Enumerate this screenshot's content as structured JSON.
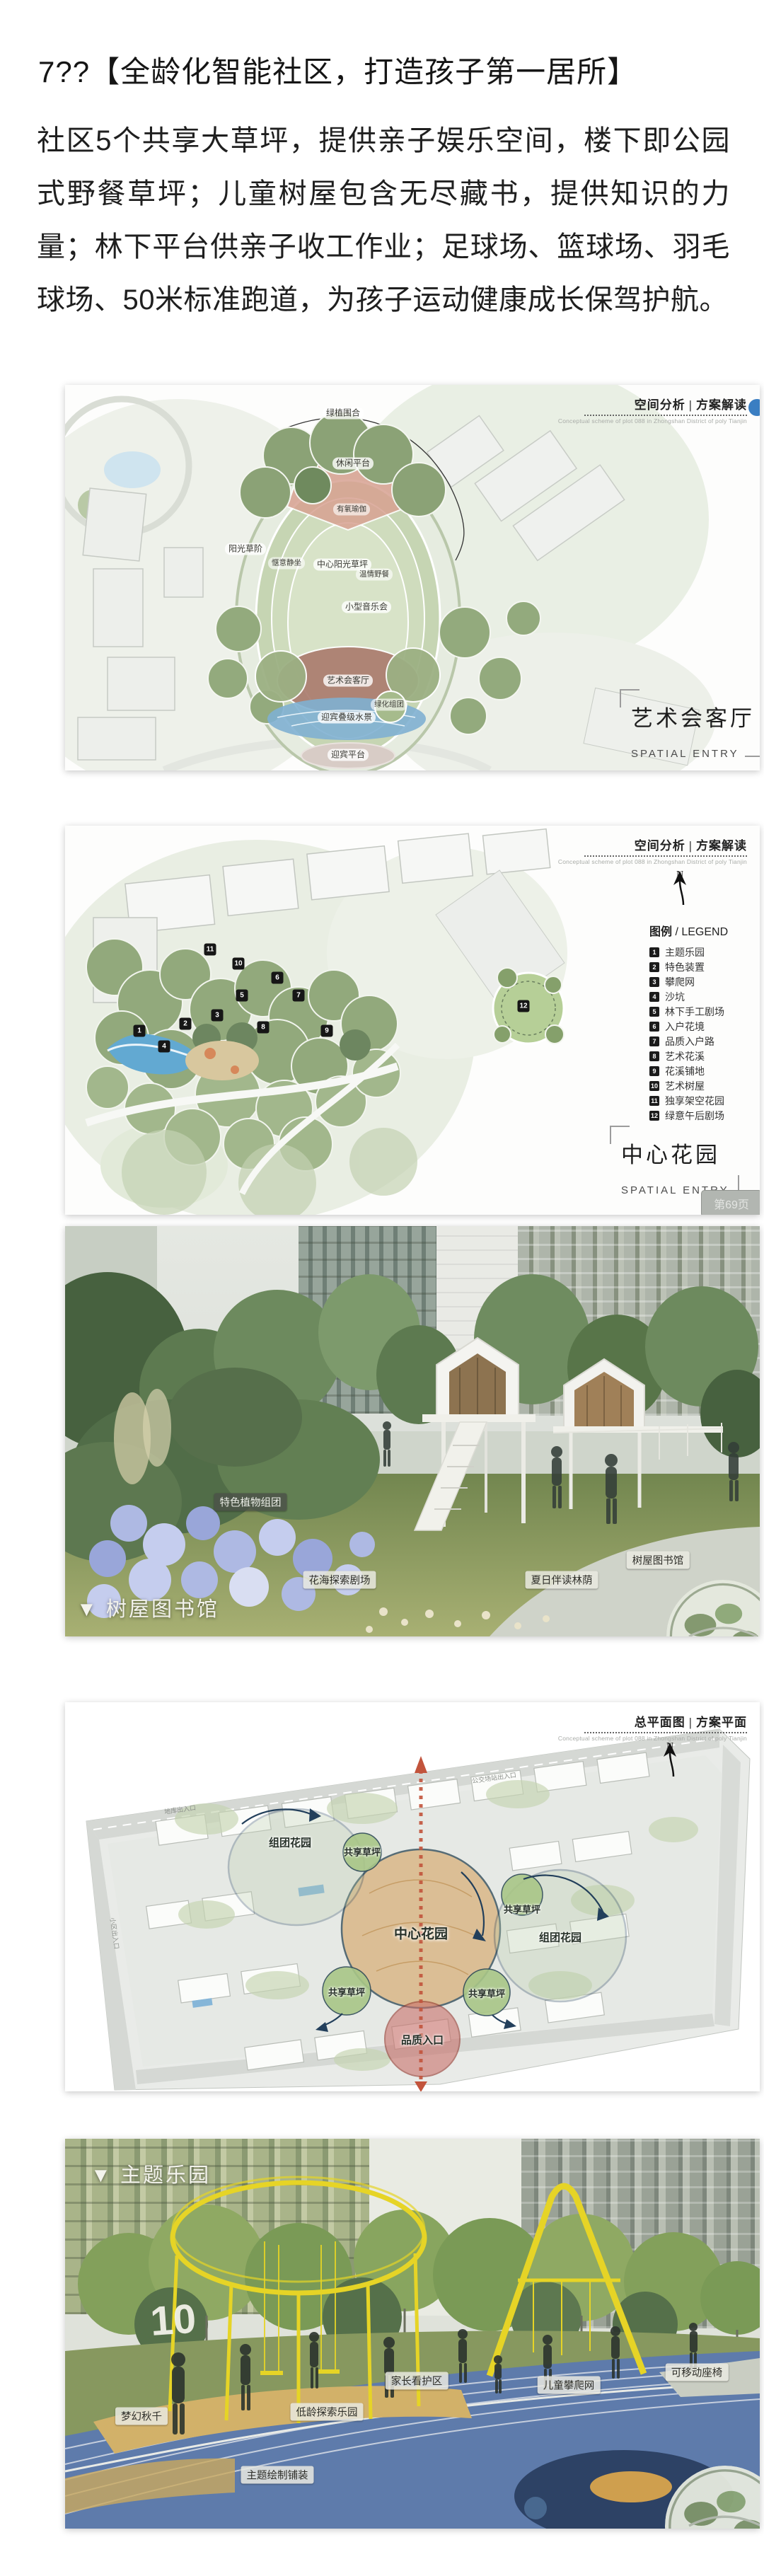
{
  "page": {
    "title": "7??【全龄化智能社区，打造孩子第一居所】",
    "paragraph": "社区5个共享大草坪，提供亲子娱乐空间，楼下即公园式野餐草坪；儿童树屋包含无尽藏书，提供知识的力量；林下平台供亲子收工作业；足球场、篮球场、羽毛球场、50米标准跑道，为孩子运动健康成长保驾护航。"
  },
  "slide_header": {
    "cn_analysis": "空间分析 | 方案解读",
    "cn_masterplan": "总平面图 | 方案平面",
    "en": "Conceptual scheme of plot 088 in Zhongshan District of poly Tianjin"
  },
  "figure1": {
    "labels": {
      "enclosure": "绿植围合",
      "leisure": "休闲平台",
      "yoga": "有氧瑜伽",
      "lawn_steps": "阳光草阶",
      "sitting": "惬意静坐",
      "central_lawn": "中心阳光草坪",
      "picnic": "温情野餐",
      "concert": "小型音乐会",
      "art_hall": "艺术会客厅",
      "green_cluster": "绿化组团",
      "water": "迎宾叠级水景",
      "platform": "迎宾平台"
    },
    "side_title": "艺术会客厅",
    "side_subtitle": "SPATIAL ENTRY"
  },
  "figure2": {
    "north": "N",
    "legend_title_cn": "图例",
    "legend_title_en": " / LEGEND",
    "legend": [
      {
        "num": "1",
        "label": "主题乐园"
      },
      {
        "num": "2",
        "label": "特色装置"
      },
      {
        "num": "3",
        "label": "攀爬网"
      },
      {
        "num": "4",
        "label": "沙坑"
      },
      {
        "num": "5",
        "label": "林下手工剧场"
      },
      {
        "num": "6",
        "label": "入户花境"
      },
      {
        "num": "7",
        "label": "品质入户路"
      },
      {
        "num": "8",
        "label": "艺术花溪"
      },
      {
        "num": "9",
        "label": "花溪铺地"
      },
      {
        "num": "10",
        "label": "艺术树屋"
      },
      {
        "num": "11",
        "label": "独享架空花园"
      },
      {
        "num": "12",
        "label": "绿意午后剧场"
      }
    ],
    "side_title": "中心花园",
    "side_subtitle": "SPATIAL ENTRY",
    "page_badge": "第69页"
  },
  "figure3": {
    "tags": {
      "plants": "特色植物组团",
      "flower": "花海探索剧场",
      "reading": "夏日伴读林荫",
      "treehouse": "树屋图书馆"
    },
    "caption": "▼ 树屋图书馆"
  },
  "figure4": {
    "north": "N",
    "labels": {
      "center": "中心花园",
      "cluster": "组团花园",
      "lawn": "共享草坪",
      "entry": "品质入口"
    },
    "road_labels": {
      "left": "小区出入口",
      "top": "公交场站出入口",
      "garage": "地库出入口"
    }
  },
  "figure5": {
    "caption": "▼ 主题乐园",
    "sculpture": "10",
    "tags": {
      "swing": "梦幻秋千",
      "toddler": "低龄探索乐园",
      "guardian": "家长看护区",
      "climb": "儿童攀爬网",
      "seat": "可移动座椅",
      "paving": "主题绘制铺装"
    }
  },
  "colors": {
    "accent_blue": "#3a7ec2",
    "navy_outline": "#223f5b",
    "center_tan": "#d8b27f",
    "axis_red": "#c2543c",
    "structure_yellow": "#e6d426"
  }
}
